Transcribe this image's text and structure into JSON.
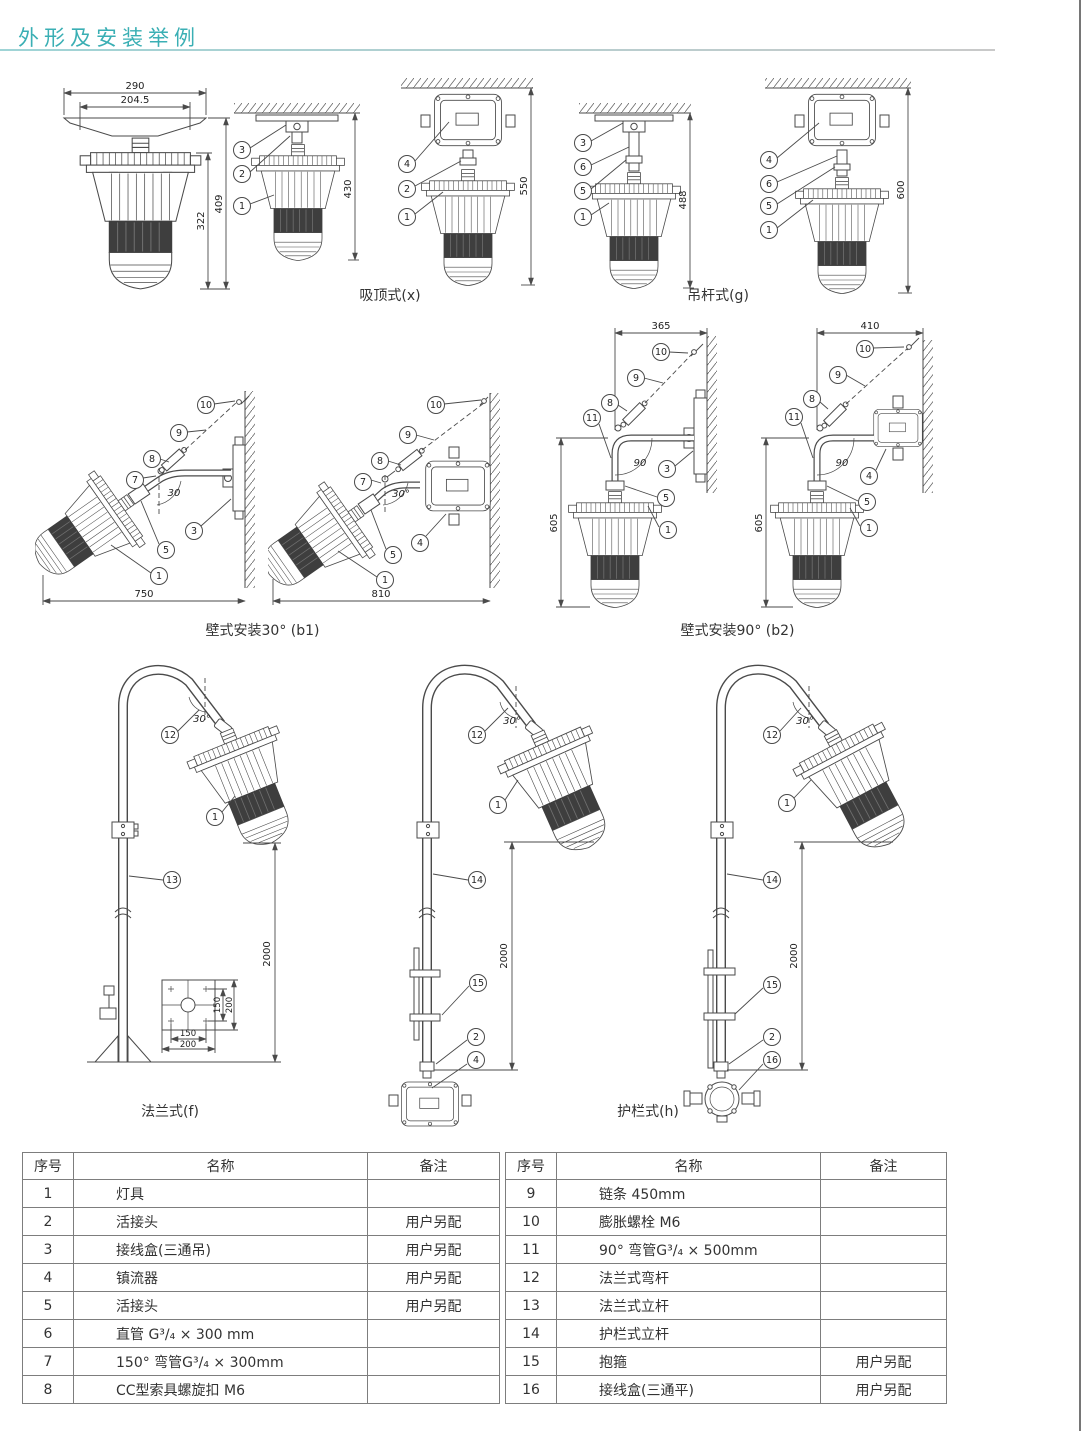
{
  "title": "外形及安装举例",
  "colors": {
    "accent": "#3aafb4"
  },
  "captions": {
    "c1": "吸顶式(x)",
    "c2": "吊杆式(g)",
    "c3": "壁式安装30° (b1)",
    "c4": "壁式安装90° (b2)",
    "c5": "法兰式(f)",
    "c6": "护栏式(h)"
  },
  "diagrams": {
    "d1": {
      "width_outer": "290",
      "width_inner": "204.5",
      "height_outer": "409",
      "height_body": "322"
    },
    "d2": {
      "callouts": [
        "3",
        "2",
        "1"
      ],
      "height": "430"
    },
    "d3": {
      "callouts": [
        "4",
        "2",
        "1"
      ],
      "height": "550"
    },
    "d4": {
      "callouts": [
        "3",
        "6",
        "5",
        "1"
      ],
      "height": "488"
    },
    "d5": {
      "callouts": [
        "4",
        "6",
        "5",
        "1"
      ],
      "height": "600"
    },
    "d6": {
      "callouts": [
        "10",
        "9",
        "8",
        "7",
        "3",
        "5",
        "1"
      ],
      "angle": "30",
      "width": "750"
    },
    "d7": {
      "callouts": [
        "10",
        "9",
        "8",
        "7",
        "4",
        "5",
        "1"
      ],
      "angle": "30°",
      "width": "810"
    },
    "d8": {
      "callouts": [
        "10",
        "9",
        "8",
        "11",
        "3",
        "5",
        "1"
      ],
      "angle": "90",
      "width_top": "365",
      "height": "605"
    },
    "d9": {
      "callouts": [
        "10",
        "9",
        "8",
        "11",
        "4",
        "5",
        "1"
      ],
      "angle": "90",
      "width_top": "410",
      "height": "605"
    },
    "d10": {
      "callouts": [
        "12",
        "1",
        "13"
      ],
      "angle": "30°",
      "height": "2000",
      "flange": {
        "bolt_v": "150",
        "plate_v": "200",
        "bolt_h": "150",
        "plate_h": "200"
      }
    },
    "d11": {
      "callouts": [
        "12",
        "1",
        "14",
        "15",
        "2",
        "4"
      ],
      "angle": "30°",
      "height": "2000"
    },
    "d12": {
      "callouts": [
        "12",
        "1",
        "14",
        "15",
        "2",
        "16"
      ],
      "angle": "30°",
      "height": "2000"
    }
  },
  "parts": {
    "headers": [
      "序号",
      "名称",
      "备注"
    ],
    "left": [
      {
        "no": "1",
        "name": "灯具",
        "note": ""
      },
      {
        "no": "2",
        "name": "活接头",
        "note": "用户另配"
      },
      {
        "no": "3",
        "name": "接线盒(三通吊)",
        "note": "用户另配"
      },
      {
        "no": "4",
        "name": "镇流器",
        "note": "用户另配"
      },
      {
        "no": "5",
        "name": "活接头",
        "note": "用户另配"
      },
      {
        "no": "6",
        "name": "直管 G³/₄ × 300 mm",
        "note": ""
      },
      {
        "no": "7",
        "name": "150° 弯管G³/₄ × 300mm",
        "note": ""
      },
      {
        "no": "8",
        "name": "CC型索具螺旋扣 M6",
        "note": ""
      }
    ],
    "right": [
      {
        "no": "9",
        "name": "链条 450mm",
        "note": ""
      },
      {
        "no": "10",
        "name": "膨胀螺栓 M6",
        "note": ""
      },
      {
        "no": "11",
        "name": "90° 弯管G³/₄ × 500mm",
        "note": ""
      },
      {
        "no": "12",
        "name": "法兰式弯杆",
        "note": ""
      },
      {
        "no": "13",
        "name": "法兰式立杆",
        "note": ""
      },
      {
        "no": "14",
        "name": "护栏式立杆",
        "note": ""
      },
      {
        "no": "15",
        "name": "抱箍",
        "note": "用户另配"
      },
      {
        "no": "16",
        "name": "接线盒(三通平)",
        "note": "用户另配"
      }
    ]
  }
}
